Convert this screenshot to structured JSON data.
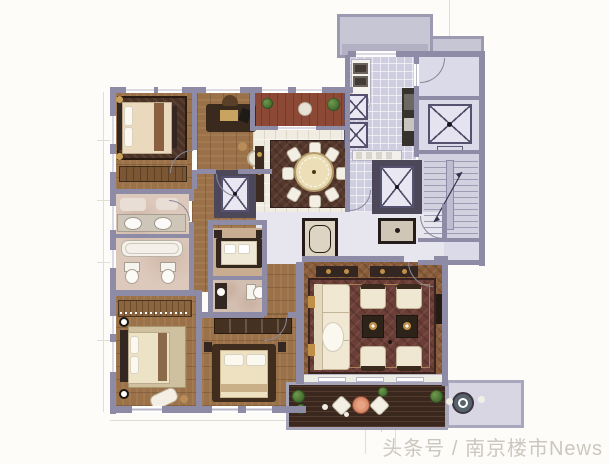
{
  "watermark": {
    "text": "头条号 / 南京楼市News"
  },
  "palette": {
    "paper": "#fdfcf9",
    "wall": "#8d8ba5",
    "wallDark": "#4c4859",
    "wood": "#9a7148",
    "herringboneWood": "#8a5d3a",
    "tileLight": "#f0ece1",
    "tileLavender": "#cfcee1",
    "lobbyLavender": "#dbdae8",
    "marble": "#dcc9bc",
    "marblePink": "#d3bfb2",
    "rugDark": "#55372b",
    "rugLiving": "#6b3e37",
    "rugBedroom": "#4a3326",
    "cream": "#f0e7d2",
    "darkFurniture": "#342620",
    "gold": "#c09048",
    "deck": "#3a271d",
    "terrace": "#d8d6e2",
    "redFloor": "#8c4a36",
    "green": "#4e7a3a",
    "watermark": "#cbc7be",
    "line": "#b9b7c9"
  },
  "symbols": {
    "elevator_symbol": "box with diagonal cross",
    "stairs_symbol": "parallel treads with direction arrow",
    "door_symbol": "quarter-circle swing arc"
  }
}
